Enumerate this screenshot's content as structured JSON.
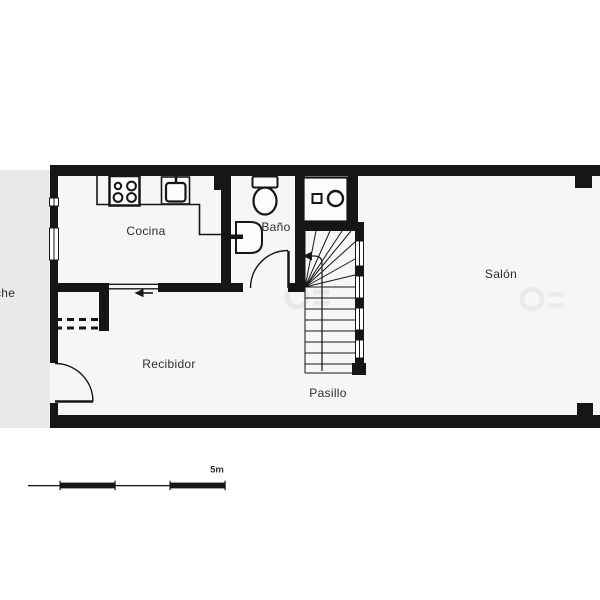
{
  "rooms": {
    "cocina": {
      "label": "Cocina"
    },
    "bano": {
      "label": "Baño"
    },
    "salon": {
      "label": "Salón"
    },
    "recibidor": {
      "label": "Recibidor"
    },
    "pasillo": {
      "label": "Pasillo"
    },
    "porche": {
      "label": "che"
    }
  },
  "scale_bar": {
    "label": "5m"
  },
  "icons": {
    "kitchen": [
      "stove-icon",
      "kitchen-sink-icon"
    ],
    "bathroom": [
      "toilet-icon",
      "bathroom-sink-icon",
      "door-swing-icon"
    ],
    "utility": [
      "washing-machine-icon"
    ],
    "circulation": [
      "staircase-icon",
      "direction-arrow-icon",
      "entrance-door-icon"
    ],
    "storage": [
      "closet-dashed-icon"
    ]
  },
  "colors": {
    "wall": "#161616",
    "floor": "#f6f6f6",
    "porch": "#eaeaea",
    "background": "#ffffff",
    "ink": "#2e2e2e"
  }
}
